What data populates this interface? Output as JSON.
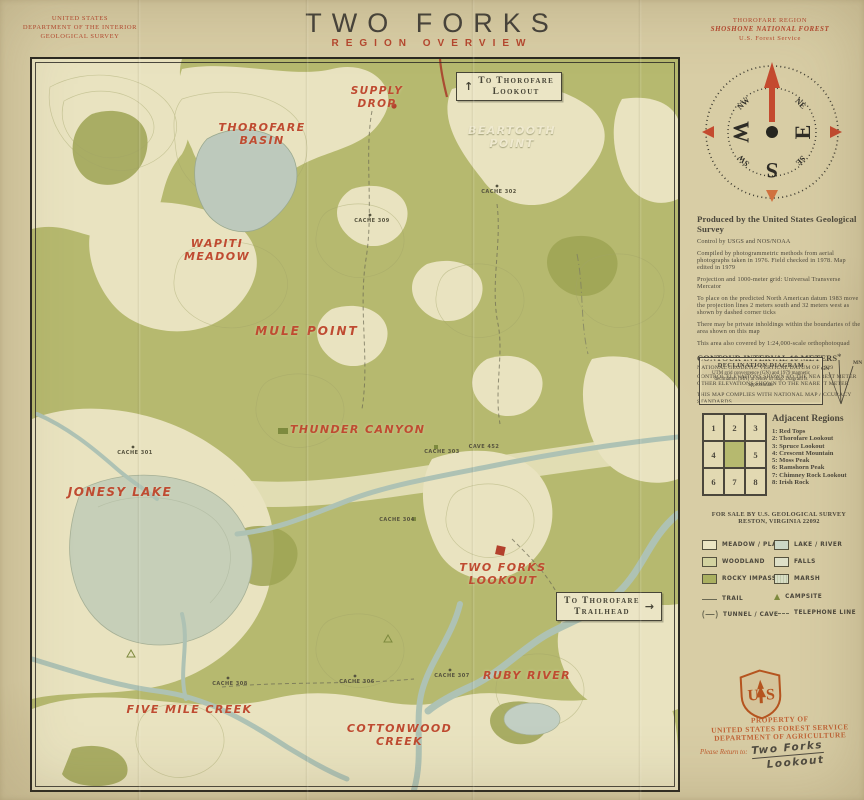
{
  "header": {
    "usgs": [
      "UNITED STATES",
      "DEPARTMENT OF THE INTERIOR",
      "GEOLOGICAL SURVEY"
    ],
    "title": "TWO FORKS",
    "subtitle": "REGION OVERVIEW",
    "forest": [
      "THOROFARE REGION",
      "SHOSHONE NATIONAL FOREST",
      "U.S. Forest Service"
    ]
  },
  "compass": {
    "w": "W",
    "e": "E",
    "s": "S",
    "nw": "NW",
    "ne": "NE",
    "sw": "SW",
    "se": "SE"
  },
  "survey": {
    "heading": "Produced by the United States Geological Survey",
    "control": "Control by USGS and NOS/NOAA",
    "p1": "Compiled by photogrammetric methods from aerial photographs taken in 1976. Field checked in 1978. Map edited in 1979",
    "p2": "Projection and 1000-meter grid: Universal Transverse Mercator",
    "p3": "To place on the predicted North American datum 1983 move the projection lines 2 meters south and 32 meters west as shown by dashed corner ticks",
    "p4": "There may be private inholdings within the boundaries of the area shown on this map",
    "p5": "This area also covered by 1:24,000-scale orthophotoquad",
    "contour": "CONTOUR INTERVAL 10 METERS",
    "datum": "NATIONAL GEODETIC VERTICAL DATUM OF 1929",
    "elev1": "CONTROL ELEVATIONS SHOWN TO THE NEAREST METER",
    "elev2": "OTHER ELEVATIONS SHOWN TO THE NEAREST METER",
    "accuracy": "THIS MAP COMPLIES WITH NATIONAL MAP ACCURACY STANDARDS"
  },
  "declination": {
    "title": "DECLINATION DIAGRAM",
    "body": "UTM grid convergence (GN) and 1979 magnetic declination (MN) at center of map. Diagram is approximate",
    "gn": "GN",
    "mn": "MN",
    "star": "*"
  },
  "adjacent": {
    "heading": "Adjacent Regions",
    "cells": [
      "1",
      "2",
      "3",
      "4",
      "",
      "5",
      "6",
      "7",
      "8"
    ],
    "items": [
      "1: Red Tops",
      "2: Thorofare Lookout",
      "3: Spruce Lookout",
      "4: Crescent Mountain",
      "5: Moss Peak",
      "6: Ramshorn Peak",
      "7: Chimney Rock Lookout",
      "8: Irish Rock"
    ]
  },
  "sale": [
    "FOR SALE BY U.S. GEOLOGICAL SURVEY",
    "RESTON, VIRGINIA 22092"
  ],
  "legend": {
    "meadow": "MEADOW / PLAIN",
    "woodland": "WOODLAND",
    "rocky": "ROCKY IMPASSE",
    "lake": "LAKE / RIVER",
    "falls": "FALLS",
    "marsh": "MARSH",
    "trail": "TRAIL",
    "campsite": "CAMPSITE",
    "tunnel": "TUNNEL / CAVE",
    "telephone": "TELEPHONE LINE"
  },
  "stamp": {
    "shield_u": "U",
    "shield_s": "S",
    "line1": "PROPERTY OF",
    "line2": "UNITED STATES FOREST SERVICE",
    "line3": "DEPARTMENT OF AGRICULTURE",
    "return_label": "Please Return to:",
    "return_line1": "Two Forks",
    "return_line2": "Lookout"
  },
  "map": {
    "labels": {
      "supply1": "SUPPLY",
      "supply2": "DROP",
      "basin1": "THOROFARE",
      "basin2": "BASIN",
      "beartooth1": "BEARTOOTH",
      "beartooth2": "POINT",
      "wapiti1": "WAPITI",
      "wapiti2": "MEADOW",
      "mule": "MULE POINT",
      "thunder": "THUNDER CANYON",
      "jonesy": "JONESY LAKE",
      "twoforks1": "TWO FORKS",
      "twoforks2": "LOOKOUT",
      "fivemile": "FIVE MILE CREEK",
      "cottonwood1": "COTTONWOOD",
      "cottonwood2": "CREEK",
      "ruby": "RUBY RIVER",
      "to_lookout1": "To Thorofare",
      "to_lookout2": "Lookout",
      "to_trailhead1": "To Thorofare",
      "to_trailhead2": "Trailhead",
      "cache301": "CACHE 301",
      "cache302": "CACHE 302",
      "cache303": "CACHE 303",
      "cache304": "CACHE 304",
      "cache306": "CACHE 306",
      "cache307": "CACHE 307",
      "cache308": "CACHE 308",
      "cache309": "CACHE 309",
      "cave452": "CAVE 452"
    }
  },
  "icons": {
    "up_arrow": "↑",
    "right_arrow": "→",
    "campsite_triangle": "▲"
  },
  "colors": {
    "paper": "#d8cda5",
    "map_meadow": "#e9e3c0",
    "woodland": "#b6b96f",
    "rocky_impasse": "#9da354",
    "lake": "#c6cfb8",
    "river": "#b0c3b5",
    "accent_red": "#b5472f",
    "label_cream": "#efe9cf",
    "ink": "#4b473c",
    "stamp_orange": "#bf5b2d"
  }
}
